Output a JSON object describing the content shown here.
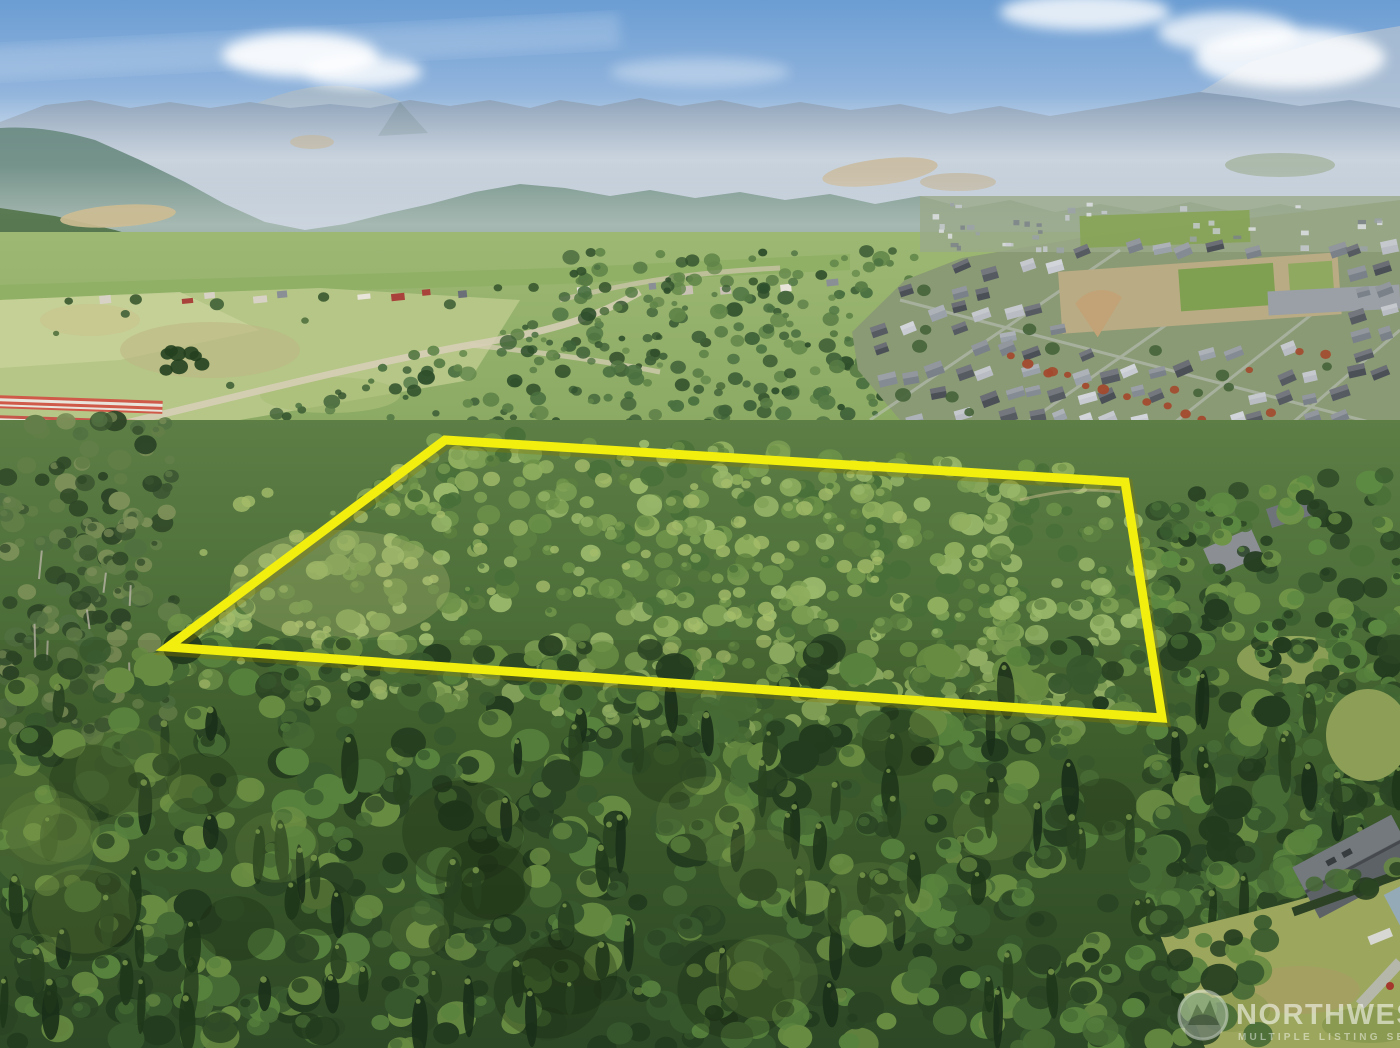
{
  "photo": {
    "type": "aerial-drone-photo",
    "description": "Aerial drone photo of a forested acreage parcel outlined in yellow, bordered by a suburban neighborhood on the right, rural pastures and farm buildings on the left, dense evergreen forest in the foreground and hazy Cascade mountains with blue sky and clouds in the background."
  },
  "boundary": {
    "points": "168,647 445,440 1125,482 1162,718",
    "color": "#f2ee0e",
    "underglow": "#8a7d00",
    "stroke_width": 9
  },
  "watermark": {
    "line1": "NORTHWEST",
    "line2": "MULTIPLE LISTING SERVICE",
    "logo": "nwmls-circle-mountains",
    "color": "#ffffff"
  },
  "palette": {
    "sky_top": "#6b9dd3",
    "sky_horizon": "#dde6ec",
    "mountain_far": "#9db0c4",
    "mountain_mid": "#708f88",
    "hills": "#51724f",
    "field_light": "#c6d098",
    "field_mid": "#b5c687",
    "forest_mid": [
      "#3f6138",
      "#4a7040",
      "#567a44",
      "#618549",
      "#2f4f2c"
    ],
    "forest_parcel": [
      "#6d9249",
      "#7da054",
      "#8fae5e",
      "#5c8040",
      "#486f38",
      "#9ab86a"
    ],
    "forest_fg": [
      "#2c4726",
      "#3a5c30",
      "#4a7038",
      "#5d8a42",
      "#243d20",
      "#6f9447"
    ],
    "forest_left": [
      "#3b5531",
      "#517041",
      "#637e48",
      "#2e4627",
      "#7c8f58"
    ],
    "conifer_dark": [
      "#20381c",
      "#2a4522",
      "#1b301b"
    ],
    "conifer_tip": "#7fa04f",
    "roof_grays": [
      "#9ba1a9",
      "#7b8189",
      "#565b62",
      "#b9bdc3",
      "#858b93",
      "#4b5057",
      "#c8ccd2"
    ],
    "rural_roofs": [
      "#e8e4da",
      "#c9c2b4",
      "#a8423a",
      "#8a8f96",
      "#d8d2c6",
      "#6b7078"
    ],
    "tree_red": "#a34a2e",
    "tree_green": "#45633a",
    "lawn": "#a8b264",
    "sand": "#cdbd92"
  }
}
